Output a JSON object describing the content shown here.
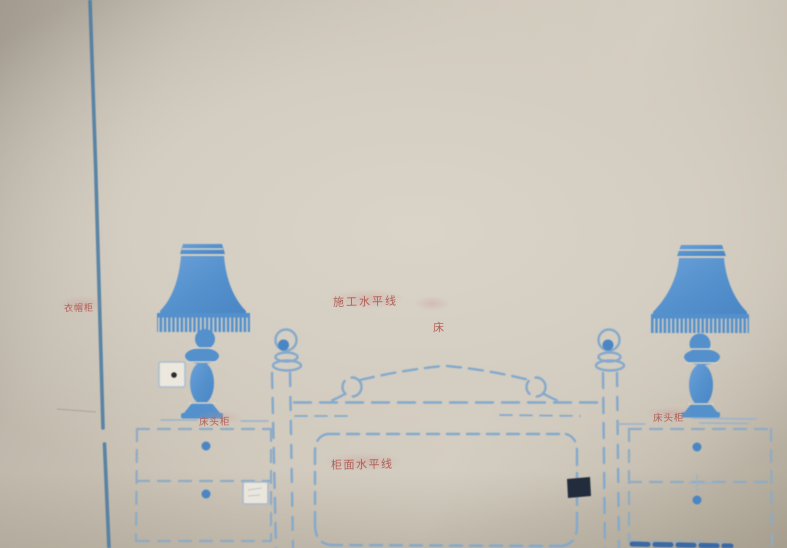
{
  "scene": {
    "description": "Photograph of a bedroom wall with blue stencilled furniture layout markings (wardrobe line, two table lamps, bed headboard, two nightstands, socket boxes) annotated with red Chinese labels",
    "colors": {
      "wall_light": "#d8d2c6",
      "wall_dark": "#a39b8f",
      "wardrobe_line_blue": "#4a7ba3",
      "stencil_dash_blue": "#84a9cc",
      "lamp_fill_blue": "#5390cc",
      "handle_dot_blue": "#4b86c4",
      "dark_junction_box": "#232c3d",
      "label_red": "#ad4f48"
    },
    "labels": {
      "wardrobe": "衣帽柜",
      "construction_level_line": "施工水平线",
      "bed": "床",
      "cabinet_surface_level_line": "柜面水平线",
      "nightstand_left": "床头柜",
      "nightstand_right": "床头柜"
    }
  }
}
